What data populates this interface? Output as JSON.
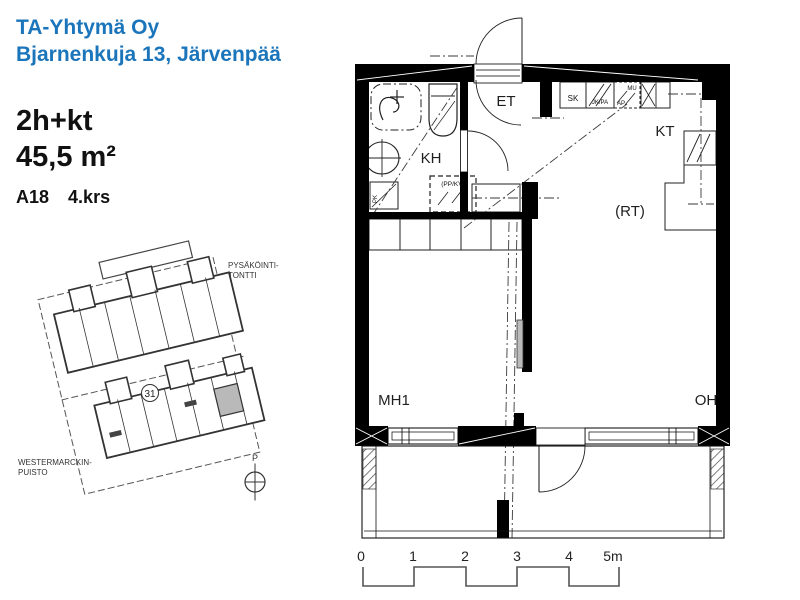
{
  "header": {
    "company": "TA-Yhtymä Oy",
    "address": "Bjarnenkuja 13, Järvenpää"
  },
  "apartment": {
    "type": "2h+kt",
    "area": "45,5 m²",
    "unit": "A18",
    "floor": "4.krs"
  },
  "site_plan": {
    "parking_label_line1": "PYSÄKÖINTI-",
    "parking_label_line2": "TONTTI",
    "park_label_line1": "WESTERMARCKIN-",
    "park_label_line2": "PUISTO",
    "plot_number": "31",
    "compass_letter": "P"
  },
  "floor_plan": {
    "rooms": {
      "entry": "ET",
      "bathroom": "KH",
      "kitchen": "KT",
      "dining": "(RT)",
      "bedroom": "MH1",
      "living": "OH"
    },
    "fixtures": {
      "cleaning_closet": "SK",
      "fridge": "JK/PA",
      "microwave": "MU",
      "dishwasher": "AP",
      "laundry_reservation": "(PP/KV)",
      "washer": "PK"
    }
  },
  "scale_bar": {
    "ticks": [
      "0",
      "1",
      "2",
      "3",
      "4",
      "5m"
    ]
  },
  "colors": {
    "accent": "#1B75BB",
    "line": "#000000",
    "muted": "#b9b9b9"
  }
}
